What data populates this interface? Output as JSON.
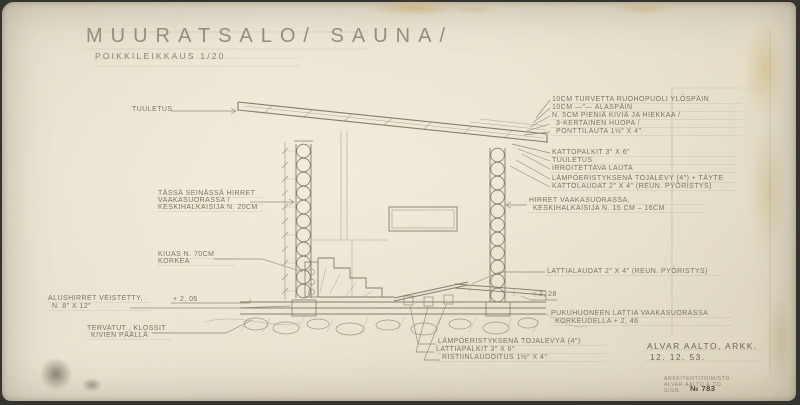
{
  "title": {
    "main": "MUURATSALO/ SAUNA/",
    "sub": "POIKKILEIKKAUS  1/20"
  },
  "labels": {
    "tuuletus_left": "TUULETUS",
    "roof_layers": [
      "10CM TURVETTA RUOHOPUOLI YLÖSPÄIN",
      "10CM    —″—      ALASPÄIN",
      "N. 5CM PIENIÄ KIVIÄ JA HIEKKAA /",
      "3-KERTAINEN HUOPA /",
      "PONTTILAUTA 1½″ x 4″"
    ],
    "roof_structure": [
      "KATTOPALKIT 3″ x 6″",
      "TUULETUS",
      "IRROITETTAVA LAUTA",
      "LÄMPÖERISTYKSENÄ TOJALEVY (4″) + TÄYTE",
      "KATTOLAUDAT 2″ x 4″ (REUN. PYÖRISTYS)"
    ],
    "logs_right": [
      "HIRRET VAAKASUORASSA,",
      "KESKIHALKAISIJA N. 15 CM – 16CM"
    ],
    "logs_left": [
      "TÄSSÄ SEINÄSSÄ HIRRET",
      "VAAKASUORASSA /",
      "KESKIHALKAISIJA N. 20CM"
    ],
    "kiuas": [
      "KIUAS N. 70CM",
      "KORKEA"
    ],
    "floor_boards": "LATTIALAUDAT 2″ x 4″ (REUN. PYÖRISTYS)",
    "level_228": "+ 2, 28",
    "level_205": "+ 2, 05",
    "dressing_floor": [
      "PUKUHUONEEN LATTIA VAAKASUORASSA",
      "KORKEUDELLA   + 2, 46"
    ],
    "sill": [
      "ALUSHIRRET VEISTETTY,",
      "N. 8″ x 12″"
    ],
    "blocks": [
      "TERVATUT , KLOSSIT",
      "KIVIEN PÄÄLLÄ"
    ],
    "floor_structure": [
      "LÄMPÖERISTYKSENÄ TOJALEVYÄ (4″)",
      "LATTIAPALKIT 3″ x 6″",
      "RISTIINLAUDOITUS 1½″ x 4″"
    ]
  },
  "signature": {
    "name": "ALVAR AALTO, ARKK.",
    "date": "12. 12. 53."
  },
  "stamp": {
    "line1": "ARKKITEHTITOIMISTO",
    "line2": "ALVAR AALTO & CO",
    "line3": "SIGN.",
    "number": "№ 783"
  },
  "colors": {
    "paper": "#e9e2cf",
    "pencil": "#847d6a",
    "stain": "#d9c28b"
  }
}
